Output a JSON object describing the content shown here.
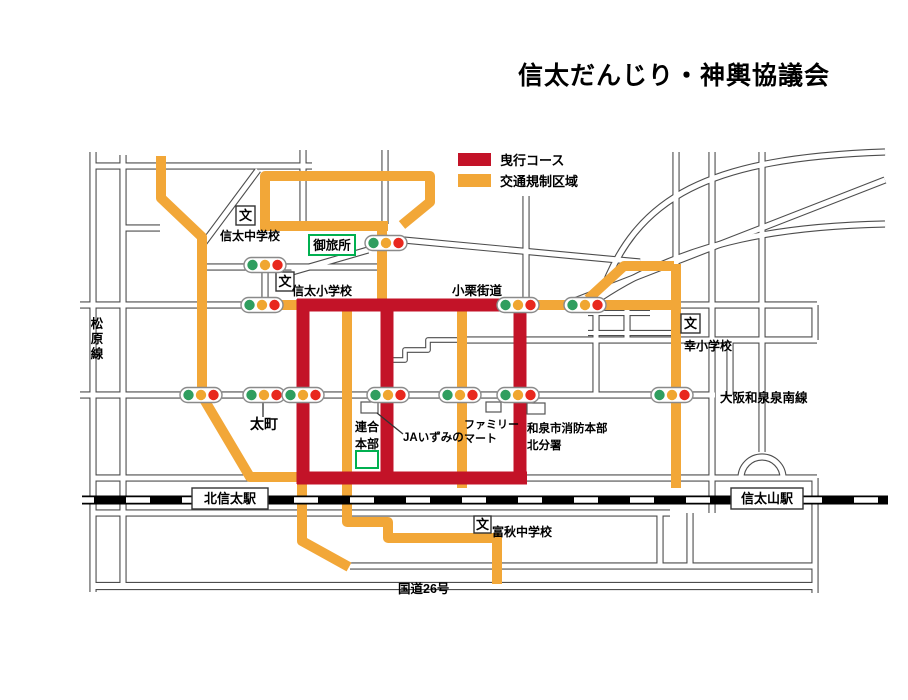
{
  "title": "信太だんじり・神輿協議会",
  "legend": {
    "items": [
      {
        "label": "曳行コース",
        "color": "#C31328"
      },
      {
        "label": "交通規制区域",
        "color": "#F2A738"
      }
    ]
  },
  "map": {
    "width": 908,
    "height": 700,
    "colors": {
      "street_outline": "#4d4d4d",
      "street_fill": "#ffffff",
      "course": "#C31328",
      "regulated": "#F2A738",
      "rail": "#000000",
      "light_green": "#2F9E5F",
      "light_amber": "#F0A630",
      "light_red": "#E8281E",
      "landmark_green": "#00B050",
      "label_color": "#000000"
    },
    "streets": [
      {
        "d": "M 93 166 H 312"
      },
      {
        "d": "M 93 152 V 592"
      },
      {
        "d": "M 123 155 V 586"
      },
      {
        "d": "M 123 228 H 160"
      },
      {
        "d": "M 200 248 L 258 170"
      },
      {
        "d": "M 303 150 V 226"
      },
      {
        "d": "M 385 150 V 224"
      },
      {
        "d": "M 200 267 H 382"
      },
      {
        "d": "M 292 272 L 368 250"
      },
      {
        "d": "M 382 238 L 640 262"
      },
      {
        "d": "M 80 305 H 817"
      },
      {
        "d": "M 265 267 V 305"
      },
      {
        "d": "M 526 196 V 305"
      },
      {
        "d": "M 600 298 C 635 195 710 158 885 152"
      },
      {
        "d": "M 600 298 C 690 238 790 226 885 224"
      },
      {
        "d": "M 572 302 L 885 180"
      },
      {
        "d": "M 712 152 V 513"
      },
      {
        "d": "M 676 152 V 265"
      },
      {
        "d": "M 762 152 V 452"
      },
      {
        "d": "M 596 305 V 395"
      },
      {
        "d": "M 627 305 V 340"
      },
      {
        "d": "M 588 313 H 650",
        "w": 4
      },
      {
        "d": "M 588 333 H 672",
        "w": 4
      },
      {
        "d": "M 457 340 H 817"
      },
      {
        "d": "M 730 340 V 395"
      },
      {
        "d": "M 815 305 V 340"
      },
      {
        "d": "M 80 395 H 715"
      },
      {
        "d": "M 93 478 H 817"
      },
      {
        "d": "M 741 478 A 21 21 0 0 1 783 478"
      },
      {
        "d": "M 815 478 V 593"
      },
      {
        "d": "M 93 513 H 670"
      },
      {
        "d": "M 660 513 V 566"
      },
      {
        "d": "M 690 513 V 566"
      },
      {
        "d": "M 350 566 H 815"
      },
      {
        "d": "M 93 586 H 815",
        "w": 6
      },
      {
        "d": "M 457 340 H 428 V 350 H 405 V 360 H 390",
        "w": 3.5
      }
    ],
    "regulated_routes": [
      {
        "d": "M 161 156 V 198 L 202 237 V 396 L 250 477 H 299"
      },
      {
        "d": "M 265 231 V 176 H 430 V 202 L 402 225"
      },
      {
        "d": "M 262 226 H 388"
      },
      {
        "d": "M 382 222 V 303"
      },
      {
        "d": "M 280 305 H 300"
      },
      {
        "d": "M 510 305 H 678"
      },
      {
        "d": "M 588 299 L 624 266 H 674"
      },
      {
        "d": "M 676 264 V 488"
      },
      {
        "d": "M 347 307 V 522 H 388 V 538 H 497 V 584"
      },
      {
        "d": "M 302 481 V 541 L 349 567"
      },
      {
        "d": "M 462 308 V 488"
      }
    ],
    "course_routes": [
      {
        "d": "M 297 305 H 513"
      },
      {
        "d": "M 303 299 V 484"
      },
      {
        "d": "M 387 303 V 480"
      },
      {
        "d": "M 520 299 V 484"
      },
      {
        "d": "M 297 478 H 527"
      }
    ],
    "railway": {
      "d": "M 82 500 H 888"
    },
    "stations": [
      {
        "name": "北信太駅",
        "x": 192,
        "y": 488,
        "w": 76,
        "h": 21
      },
      {
        "name": "信太山駅",
        "x": 731,
        "y": 488,
        "w": 72,
        "h": 21
      }
    ],
    "traffic_lights": [
      {
        "x": 262,
        "y": 305
      },
      {
        "x": 518,
        "y": 305
      },
      {
        "x": 585,
        "y": 305
      },
      {
        "x": 265,
        "y": 265
      },
      {
        "x": 386,
        "y": 243
      },
      {
        "x": 201,
        "y": 395
      },
      {
        "x": 264,
        "y": 395
      },
      {
        "x": 303,
        "y": 395
      },
      {
        "x": 388,
        "y": 395
      },
      {
        "x": 460,
        "y": 395
      },
      {
        "x": 518,
        "y": 395
      },
      {
        "x": 672,
        "y": 395
      }
    ],
    "schools": [
      {
        "symbol": "文",
        "box": {
          "x": 236,
          "y": 206,
          "w": 19,
          "h": 19
        },
        "label": "信太中学校",
        "lx": 220,
        "ly": 240
      },
      {
        "symbol": "文",
        "box": {
          "x": 276,
          "y": 272,
          "w": 18,
          "h": 19
        },
        "label": "信太小学校",
        "lx": 292,
        "ly": 295
      },
      {
        "symbol": "文",
        "box": {
          "x": 681,
          "y": 314,
          "w": 19,
          "h": 19
        },
        "label": "幸小学校",
        "lx": 684,
        "ly": 350
      },
      {
        "symbol": "文",
        "box": {
          "x": 474,
          "y": 516,
          "w": 17,
          "h": 17
        },
        "label": "富秋中学校",
        "lx": 492,
        "ly": 536
      }
    ],
    "green_markers": [
      {
        "label": "御旅所",
        "x": 309,
        "y": 235,
        "w": 46,
        "h": 20
      },
      {
        "label": "",
        "x": 356,
        "y": 451,
        "w": 22,
        "h": 17
      }
    ],
    "buildings": [
      {
        "x": 361,
        "y": 402,
        "w": 17,
        "h": 11
      },
      {
        "x": 486,
        "y": 402,
        "w": 15,
        "h": 10
      },
      {
        "x": 527,
        "y": 403,
        "w": 18,
        "h": 11
      }
    ],
    "labels": [
      {
        "text": "小栗街道",
        "x": 452,
        "y": 295,
        "size": 12.5
      },
      {
        "text": "大阪和泉泉南線",
        "x": 720,
        "y": 402,
        "size": 12.5
      },
      {
        "text": "太町",
        "x": 250,
        "y": 429,
        "size": 14
      },
      {
        "text": "連合",
        "x": 355,
        "y": 431,
        "size": 12
      },
      {
        "text": "本部",
        "x": 355,
        "y": 448,
        "size": 12
      },
      {
        "text": "JAいずみの",
        "x": 403,
        "y": 441,
        "size": 11.5
      },
      {
        "text": "ファミリー",
        "x": 464,
        "y": 428,
        "size": 11
      },
      {
        "text": "マート",
        "x": 464,
        "y": 442,
        "size": 11
      },
      {
        "text": "和泉市消防本部",
        "x": 527,
        "y": 432,
        "size": 11.5
      },
      {
        "text": "北分署",
        "x": 527,
        "y": 449,
        "size": 11.5
      },
      {
        "text": "国道26号",
        "x": 398,
        "y": 593,
        "size": 12.5
      }
    ],
    "vertical_labels": [
      {
        "text": "松原線",
        "x": 97,
        "y": 328,
        "size": 12.5,
        "dy": 15
      }
    ],
    "pointer_lines": [
      {
        "x1": 263,
        "y1": 403,
        "x2": 263,
        "y2": 417
      },
      {
        "x1": 377,
        "y1": 413,
        "x2": 403,
        "y2": 434
      }
    ]
  }
}
